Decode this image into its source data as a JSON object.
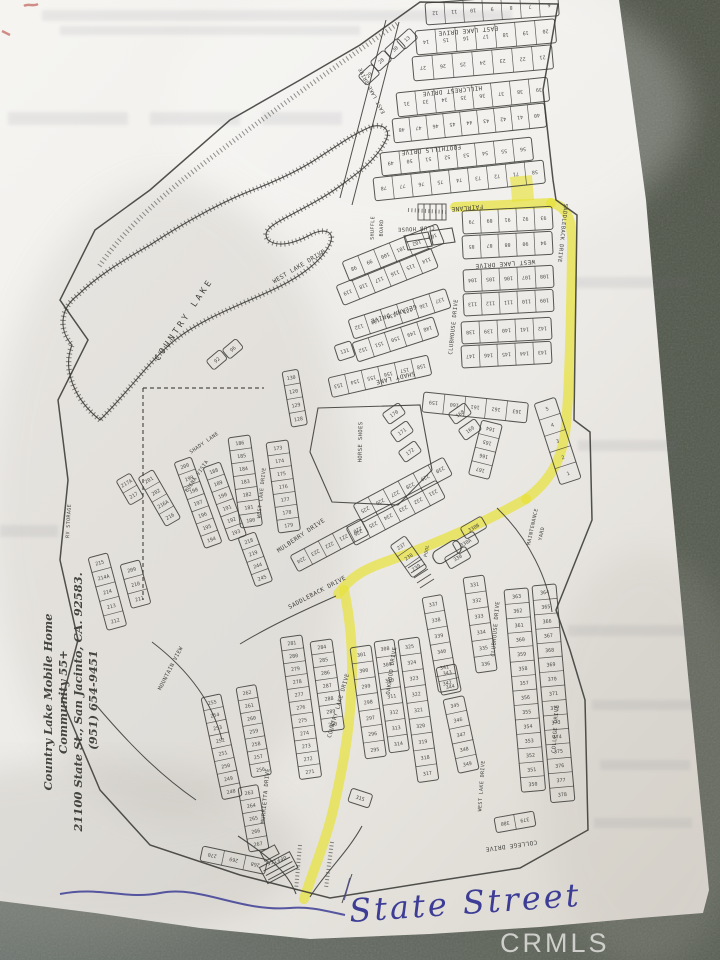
{
  "paper": {
    "watermark": "CRMLS"
  },
  "annotations": {
    "handwritten_street": "State Street"
  },
  "address_block": {
    "lines": [
      "Country Lake Mobile Home",
      "Community  55+",
      "21100 State St., San Jacinto, CA. 92583.",
      "(951) 654-9451"
    ]
  },
  "map": {
    "lake_label": "COUNTRY LAKE",
    "route": {
      "color": "#e8e23b",
      "segments": [
        "M 455,207 L 551,203",
        "M 551,203 C 568,206 573,222 572,250 C 571,330 569,390 566,425 C 563,460 549,482 526,499",
        "M 526,499 C 480,525 430,546 385,562 C 362,570 350,578 338,594",
        "M 344,590 C 350,618 354,655 351,695 C 349,737 342,770 334,806 C 327,838 314,868 304,899"
      ],
      "lot_rect": {
        "x": 510,
        "y": 177,
        "w": 22,
        "h": 25,
        "a": -5
      }
    },
    "street_labels": [
      {
        "t": "EAST LAKE DRIVE",
        "x": 468,
        "y": 29,
        "a": 175
      },
      {
        "t": "EAST LAKE DRIVE",
        "x": 373,
        "y": 90,
        "a": 242,
        "s": 5
      },
      {
        "t": "HILLCREST DRIVE",
        "x": 452,
        "y": 89,
        "a": 174
      },
      {
        "t": "FOOTHILLS DRIVE",
        "x": 431,
        "y": 148,
        "a": 174
      },
      {
        "t": "FAIRLANE",
        "x": 467,
        "y": 206,
        "a": 175
      },
      {
        "t": "SADDLEBACK DRIVE",
        "x": 561,
        "y": 233,
        "a": 96,
        "s": 5.5
      },
      {
        "t": "WEST LAKE DRIVE",
        "x": 505,
        "y": 262,
        "a": 176
      },
      {
        "t": "CLUBHOUSE DRIVE",
        "x": 455,
        "y": 327,
        "a": -84,
        "s": 5.5
      },
      {
        "t": "WEST LAKE DRIVE",
        "x": 300,
        "y": 268,
        "a": -31
      },
      {
        "t": "GELANN DRIVE",
        "x": 393,
        "y": 312,
        "a": 162
      },
      {
        "t": "SHADY LANE",
        "x": 395,
        "y": 376,
        "a": 167
      },
      {
        "t": "SHADY LANE",
        "x": 205,
        "y": 444,
        "a": -35,
        "s": 5
      },
      {
        "t": "WEST LAKE DRIVE",
        "x": 263,
        "y": 493,
        "a": -84,
        "s": 5
      },
      {
        "t": "BUENA VISTA",
        "x": 198,
        "y": 477,
        "a": -56,
        "s": 5
      },
      {
        "t": "MULBERRY DRIVE",
        "x": 302,
        "y": 537,
        "a": -34
      },
      {
        "t": "SADDLEBACK DRIVE",
        "x": 318,
        "y": 594,
        "a": -28
      },
      {
        "t": "MOUNTAIN VIEW",
        "x": 172,
        "y": 669,
        "a": -63,
        "s": 5.5
      },
      {
        "t": "MURRIETTA DRIVE",
        "x": 267,
        "y": 796,
        "a": -85,
        "s": 5.5
      },
      {
        "t": "COUNTRY LAKE DRIVE",
        "x": 340,
        "y": 706,
        "a": -74,
        "s": 5.5
      },
      {
        "t": "OAKWOOD DRIVE",
        "x": 393,
        "y": 671,
        "a": -82,
        "s": 5.5
      },
      {
        "t": "CLUBHOUSE DRIVE",
        "x": 497,
        "y": 629,
        "a": -85,
        "s": 5.5
      },
      {
        "t": "WEST LAKE DRIVE",
        "x": 483,
        "y": 786,
        "a": -86,
        "s": 5
      },
      {
        "t": "COLLEGE DRIVE",
        "x": 557,
        "y": 729,
        "a": -86,
        "s": 5.5
      },
      {
        "t": "COLLEGE DRIVE",
        "x": 511,
        "y": 844,
        "a": 172
      },
      {
        "t": "COUNTRY LAKE",
        "x": 186,
        "y": 321,
        "a": -56,
        "s": 8.5,
        "ls": 3
      }
    ],
    "facility_labels": [
      {
        "t": "SHUFFLE",
        "x": 374,
        "y": 228,
        "a": -88,
        "s": 5
      },
      {
        "t": "BOARD",
        "x": 383,
        "y": 228,
        "a": -88,
        "s": 5
      },
      {
        "t": "CLUB HOUSE",
        "x": 416,
        "y": 227,
        "a": 177,
        "s": 5.5
      },
      {
        "t": "HORSE SHOES",
        "x": 362,
        "y": 442,
        "a": -89,
        "s": 5.5
      },
      {
        "t": "MAINTENANCE",
        "x": 534,
        "y": 527,
        "a": -78,
        "s": 5
      },
      {
        "t": "YARD",
        "x": 543,
        "y": 534,
        "a": -78,
        "s": 5
      },
      {
        "t": "RV STORAGE",
        "x": 70,
        "y": 521,
        "a": -87,
        "s": 5
      },
      {
        "t": "POOL",
        "x": 428,
        "y": 551,
        "a": -80,
        "s": 4.5
      },
      {
        "t": "OFFICE",
        "x": 276,
        "y": 859,
        "a": 162,
        "s": 5
      }
    ],
    "blocks": [
      {
        "x": 425,
        "y": 3,
        "a": -4,
        "w": 19,
        "h": 22,
        "f": 1,
        "nums": [
          "12",
          "11",
          "10",
          "9",
          "8",
          "7",
          "6"
        ]
      },
      {
        "x": 415,
        "y": 31,
        "a": -5,
        "w": 20,
        "h": 24,
        "f": 1,
        "nums": [
          "14",
          "15",
          "16",
          "17",
          "18",
          "19",
          "20"
        ]
      },
      {
        "x": 412,
        "y": 57,
        "a": -5,
        "w": 20,
        "h": 24,
        "f": 1,
        "nums": [
          "27",
          "26",
          "25",
          "24",
          "23",
          "22",
          "21"
        ]
      },
      {
        "x": 396,
        "y": 93,
        "a": -6,
        "w": 19,
        "h": 24,
        "f": 1,
        "nums": [
          "31",
          "33",
          "34",
          "35",
          "36",
          "37",
          "38",
          "39"
        ]
      },
      {
        "x": 392,
        "y": 119,
        "a": -6,
        "w": 17,
        "h": 24,
        "f": 1,
        "nums": [
          "48",
          "47",
          "46",
          "45",
          "44",
          "43",
          "42",
          "41",
          "40"
        ]
      },
      {
        "x": 380,
        "y": 153,
        "a": -6,
        "w": 19,
        "h": 23,
        "f": 1,
        "nums": [
          "49",
          "50",
          "51",
          "52",
          "53",
          "54",
          "55",
          "56"
        ]
      },
      {
        "x": 373,
        "y": 178,
        "a": -6,
        "w": 19,
        "h": 23,
        "f": 1,
        "nums": [
          "78",
          "77",
          "76",
          "75",
          "74",
          "73",
          "72",
          "71",
          "58"
        ]
      },
      {
        "x": 396,
        "y": 40,
        "a": -42,
        "w": 18,
        "h": 13,
        "nums": [
          "13"
        ]
      },
      {
        "x": 384,
        "y": 50,
        "a": -42,
        "w": 18,
        "h": 13,
        "nums": [
          "30"
        ]
      },
      {
        "x": 370,
        "y": 62,
        "a": -42,
        "w": 18,
        "h": 13,
        "nums": [
          "28"
        ]
      },
      {
        "x": 358,
        "y": 76,
        "a": -42,
        "w": 18,
        "h": 13,
        "nums": [
          "29"
        ]
      },
      {
        "x": 462,
        "y": 211,
        "a": -3,
        "w": 18,
        "h": 23,
        "f": 1,
        "nums": [
          "79",
          "89",
          "91",
          "92",
          "93"
        ]
      },
      {
        "x": 462,
        "y": 236,
        "a": -3,
        "w": 18,
        "h": 23,
        "f": 1,
        "nums": [
          "85",
          "87",
          "88",
          "90",
          "94"
        ]
      },
      {
        "x": 463,
        "y": 270,
        "a": -3,
        "w": 18,
        "h": 22,
        "f": 1,
        "nums": [
          "104",
          "105",
          "106",
          "107",
          "108"
        ]
      },
      {
        "x": 463,
        "y": 294,
        "a": -3,
        "w": 18,
        "h": 22,
        "f": 1,
        "nums": [
          "113",
          "112",
          "111",
          "110",
          "109"
        ]
      },
      {
        "x": 461,
        "y": 322,
        "a": -3,
        "w": 18,
        "h": 22,
        "f": 1,
        "nums": [
          "138",
          "139",
          "140",
          "141",
          "142"
        ]
      },
      {
        "x": 461,
        "y": 346,
        "a": -3,
        "w": 18,
        "h": 22,
        "f": 1,
        "nums": [
          "147",
          "146",
          "145",
          "144",
          "143"
        ]
      },
      {
        "x": 424,
        "y": 392,
        "a": 6,
        "w": 21,
        "h": 20,
        "f": 1,
        "nums": [
          "159",
          "160",
          "161",
          "162",
          "163"
        ]
      },
      {
        "x": 482,
        "y": 420,
        "a": 14,
        "w": 21,
        "h": 14,
        "c": 1,
        "f": 1,
        "nums": [
          "164",
          "165",
          "166",
          "167"
        ]
      },
      {
        "x": 534,
        "y": 404,
        "a": -18,
        "w": 22,
        "h": 17,
        "c": 1,
        "nums": [
          "5",
          "4",
          "3",
          "2",
          "1"
        ]
      },
      {
        "x": 342,
        "y": 262,
        "a": -22,
        "w": 17,
        "h": 21,
        "f": 1,
        "nums": [
          "98",
          "99",
          "100",
          "101",
          "102",
          "103"
        ]
      },
      {
        "x": 336,
        "y": 286,
        "a": -22,
        "w": 17,
        "h": 21,
        "f": 1,
        "nums": [
          "119",
          "118",
          "117",
          "116",
          "115",
          "114"
        ]
      },
      {
        "x": 348,
        "y": 320,
        "a": -18,
        "w": 17,
        "h": 20,
        "f": 1,
        "nums": [
          "132",
          "133",
          "134",
          "135",
          "136",
          "137"
        ]
      },
      {
        "x": 352,
        "y": 343,
        "a": -18,
        "w": 17,
        "h": 20,
        "f": 1,
        "nums": [
          "152",
          "151",
          "150",
          "149",
          "148"
        ]
      },
      {
        "x": 334,
        "y": 346,
        "a": -18,
        "w": 17,
        "h": 16,
        "nums": [
          "131"
        ]
      },
      {
        "x": 328,
        "y": 378,
        "a": -13,
        "w": 17,
        "h": 20,
        "f": 1,
        "nums": [
          "153",
          "154",
          "155",
          "156",
          "157",
          "158"
        ]
      },
      {
        "x": 282,
        "y": 372,
        "a": -10,
        "w": 16,
        "h": 14,
        "c": 1,
        "nums": [
          "130",
          "120",
          "129",
          "128"
        ]
      },
      {
        "x": 228,
        "y": 438,
        "a": -8,
        "w": 22,
        "h": 13,
        "c": 1,
        "nums": [
          "186",
          "185",
          "184",
          "183",
          "182",
          "181",
          "180"
        ]
      },
      {
        "x": 266,
        "y": 443,
        "a": -8,
        "w": 22,
        "h": 13,
        "c": 1,
        "nums": [
          "173",
          "174",
          "175",
          "176",
          "177",
          "178",
          "179"
        ]
      },
      {
        "x": 174,
        "y": 463,
        "a": -20,
        "w": 18,
        "h": 13,
        "c": 1,
        "nums": [
          "200",
          "199",
          "198",
          "197",
          "196",
          "195",
          "194"
        ]
      },
      {
        "x": 203,
        "y": 468,
        "a": -20,
        "w": 18,
        "h": 13,
        "c": 1,
        "nums": [
          "188",
          "189",
          "190",
          "191",
          "192",
          "193"
        ]
      },
      {
        "x": 116,
        "y": 481,
        "a": -30,
        "w": 16,
        "h": 14,
        "c": 1,
        "nums": [
          "217A",
          "217"
        ]
      },
      {
        "x": 138,
        "y": 478,
        "a": -30,
        "w": 17,
        "h": 14,
        "c": 1,
        "nums": [
          "201",
          "202",
          "216A",
          "216"
        ]
      },
      {
        "x": 88,
        "y": 558,
        "a": -15,
        "w": 20,
        "h": 15,
        "c": 1,
        "nums": [
          "215",
          "214A",
          "214",
          "213",
          "212"
        ]
      },
      {
        "x": 120,
        "y": 565,
        "a": -15,
        "w": 20,
        "h": 15,
        "c": 1,
        "nums": [
          "209",
          "210",
          "211"
        ]
      },
      {
        "x": 238,
        "y": 538,
        "a": -20,
        "w": 18,
        "h": 13,
        "c": 1,
        "nums": [
          "218",
          "219",
          "244",
          "245"
        ]
      },
      {
        "x": 353,
        "y": 505,
        "a": -28,
        "w": 17,
        "h": 20,
        "f": 1,
        "nums": [
          "225",
          "226",
          "227",
          "228",
          "229",
          "230"
        ]
      },
      {
        "x": 346,
        "y": 528,
        "a": -28,
        "w": 17,
        "h": 20,
        "f": 1,
        "nums": [
          "236",
          "235",
          "234",
          "233",
          "232",
          "231"
        ]
      },
      {
        "x": 290,
        "y": 556,
        "a": -28,
        "w": 16,
        "h": 18,
        "f": 1,
        "nums": [
          "224",
          "223",
          "222",
          "221",
          "220"
        ]
      },
      {
        "x": 390,
        "y": 546,
        "a": -35,
        "w": 18,
        "h": 13,
        "c": 1,
        "nums": [
          "237",
          "238",
          "239"
        ]
      },
      {
        "x": 448,
        "y": 414,
        "a": -35,
        "w": 20,
        "h": 13,
        "nums": [
          "168"
        ]
      },
      {
        "x": 458,
        "y": 430,
        "a": -35,
        "w": 20,
        "h": 13,
        "nums": [
          "169"
        ]
      },
      {
        "x": 382,
        "y": 414,
        "a": -35,
        "w": 20,
        "h": 13,
        "nums": [
          "170"
        ]
      },
      {
        "x": 390,
        "y": 432,
        "a": -35,
        "w": 20,
        "h": 13,
        "nums": [
          "171"
        ]
      },
      {
        "x": 398,
        "y": 452,
        "a": -35,
        "w": 20,
        "h": 13,
        "nums": [
          "172"
        ]
      },
      {
        "x": 222,
        "y": 350,
        "a": -40,
        "w": 18,
        "h": 12,
        "nums": [
          "96"
        ]
      },
      {
        "x": 206,
        "y": 361,
        "a": -40,
        "w": 18,
        "h": 12,
        "nums": [
          "92"
        ]
      },
      {
        "x": 280,
        "y": 638,
        "a": -8,
        "w": 22,
        "h": 13,
        "c": 1,
        "nums": [
          "281",
          "280",
          "279",
          "278",
          "277",
          "276",
          "275",
          "274",
          "273",
          "272",
          "271"
        ]
      },
      {
        "x": 310,
        "y": 642,
        "a": -8,
        "w": 22,
        "h": 13,
        "c": 1,
        "nums": [
          "284",
          "285",
          "286",
          "287",
          "288",
          "289",
          "290"
        ]
      },
      {
        "x": 236,
        "y": 688,
        "a": -10,
        "w": 20,
        "h": 13,
        "c": 1,
        "nums": [
          "262",
          "261",
          "260",
          "259",
          "258",
          "257",
          "256"
        ]
      },
      {
        "x": 201,
        "y": 698,
        "a": -12,
        "w": 20,
        "h": 13,
        "c": 1,
        "nums": [
          "255",
          "254",
          "253",
          "252",
          "251",
          "250",
          "249",
          "248"
        ]
      },
      {
        "x": 238,
        "y": 788,
        "a": -10,
        "w": 20,
        "h": 13,
        "c": 1,
        "nums": [
          "263",
          "264",
          "265",
          "266",
          "267"
        ]
      },
      {
        "x": 203,
        "y": 846,
        "a": 12,
        "w": 22,
        "h": 15,
        "f": 1,
        "nums": [
          "270",
          "269",
          "268"
        ]
      },
      {
        "x": 350,
        "y": 648,
        "a": -8,
        "w": 21,
        "h": 16,
        "c": 1,
        "nums": [
          "301",
          "300",
          "299",
          "298",
          "297",
          "296",
          "295"
        ]
      },
      {
        "x": 374,
        "y": 642,
        "a": -8,
        "w": 20,
        "h": 16,
        "c": 1,
        "nums": [
          "308",
          "309",
          "310",
          "311",
          "312",
          "313",
          "314"
        ]
      },
      {
        "x": 352,
        "y": 788,
        "a": 18,
        "w": 22,
        "h": 14,
        "nums": [
          "315"
        ]
      },
      {
        "x": 398,
        "y": 640,
        "a": -8,
        "w": 21,
        "h": 16,
        "c": 1,
        "nums": [
          "325",
          "324",
          "323",
          "322",
          "321",
          "320",
          "319",
          "318",
          "317"
        ]
      },
      {
        "x": 422,
        "y": 598,
        "a": -10,
        "w": 20,
        "h": 16,
        "c": 1,
        "nums": [
          "337",
          "338",
          "339",
          "340",
          "341",
          "342"
        ]
      },
      {
        "x": 463,
        "y": 578,
        "a": -8,
        "w": 21,
        "h": 16,
        "c": 1,
        "nums": [
          "331",
          "332",
          "333",
          "334",
          "335",
          "336"
        ]
      },
      {
        "x": 436,
        "y": 668,
        "a": -12,
        "w": 20,
        "h": 14,
        "c": 1,
        "nums": [
          "343",
          "344"
        ]
      },
      {
        "x": 443,
        "y": 700,
        "a": -12,
        "w": 21,
        "h": 15,
        "c": 1,
        "nums": [
          "345",
          "346",
          "347",
          "348",
          "349"
        ]
      },
      {
        "x": 504,
        "y": 590,
        "a": -5,
        "w": 24,
        "h": 14.5,
        "c": 1,
        "nums": [
          "363",
          "362",
          "361",
          "360",
          "359",
          "358",
          "357",
          "356",
          "355",
          "354",
          "353",
          "352",
          "351",
          "350"
        ]
      },
      {
        "x": 532,
        "y": 586,
        "a": -5,
        "w": 24,
        "h": 14.5,
        "c": 1,
        "nums": [
          "364",
          "365",
          "366",
          "367",
          "368",
          "369",
          "370",
          "371",
          "372",
          "373",
          "374",
          "375",
          "376",
          "377",
          "378"
        ]
      },
      {
        "x": 494,
        "y": 818,
        "a": -10,
        "w": 20,
        "h": 15,
        "f": 1,
        "nums": [
          "380",
          "379"
        ]
      },
      {
        "x": 460,
        "y": 528,
        "a": -30,
        "w": 24,
        "h": 13,
        "nums": [
          "330B"
        ]
      },
      {
        "x": 452,
        "y": 543,
        "a": -30,
        "w": 24,
        "h": 13,
        "nums": [
          "330A"
        ]
      },
      {
        "x": 444,
        "y": 558,
        "a": -30,
        "w": 24,
        "h": 13,
        "nums": [
          "330"
        ]
      }
    ]
  }
}
